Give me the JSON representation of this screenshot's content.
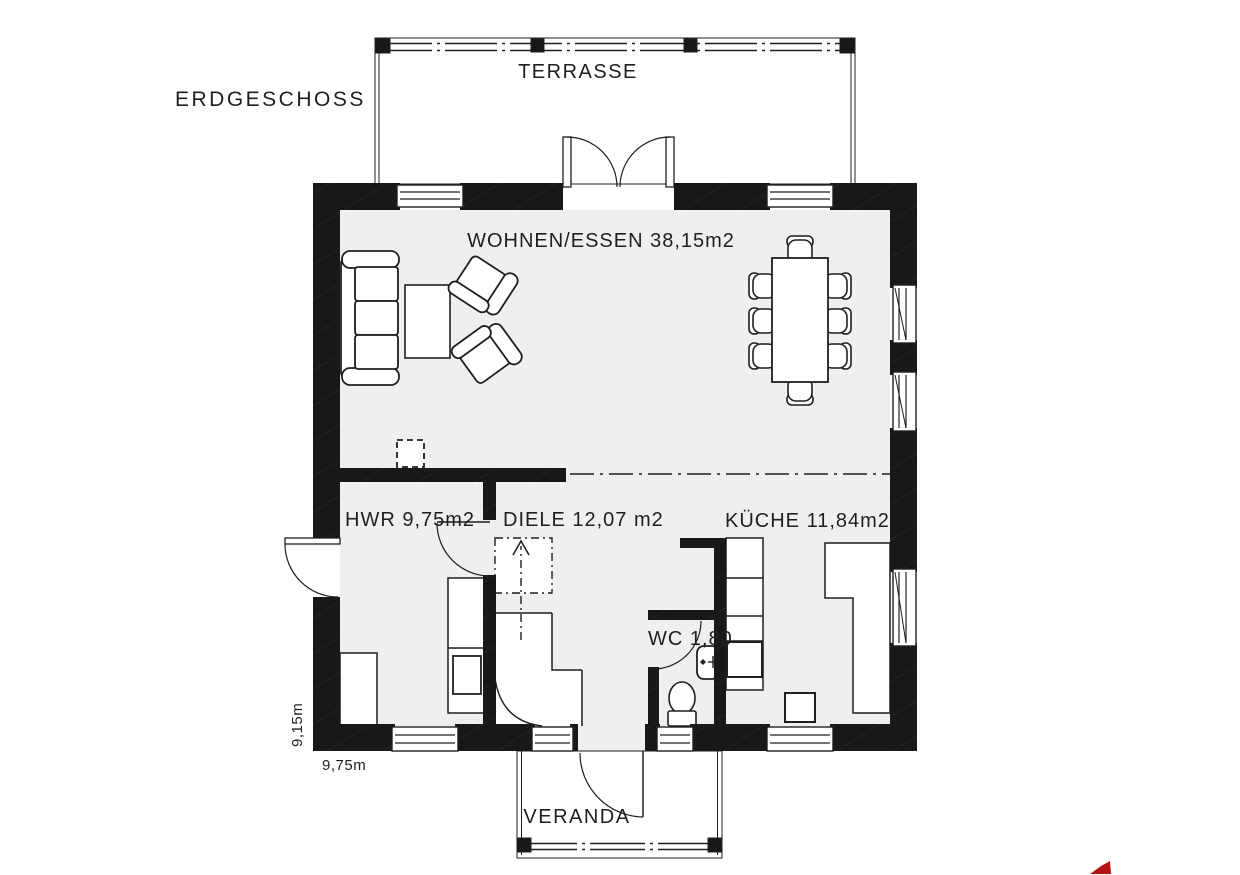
{
  "title": {
    "floor": "ERDGESCHOSS"
  },
  "outdoor": {
    "terrace_label": "TERRASSE",
    "veranda_label": "VERANDA"
  },
  "rooms": {
    "living": {
      "label": "WOHNEN/ESSEN 38,15m2"
    },
    "utility": {
      "label": "HWR 9,75m2"
    },
    "hall": {
      "label": "DIELE 12,07 m2"
    },
    "kitchen": {
      "label": "KÜCHE 11,84m2"
    },
    "wc": {
      "label": "WC 1,80"
    }
  },
  "dimensions": {
    "depth": "9,15m",
    "width": "9,75m"
  },
  "colors": {
    "wall": "#181818",
    "wall_hatch": "#2e2e2e",
    "floor": "#efeff0",
    "line": "#1f1f1f",
    "logo_red": "#b51414"
  }
}
